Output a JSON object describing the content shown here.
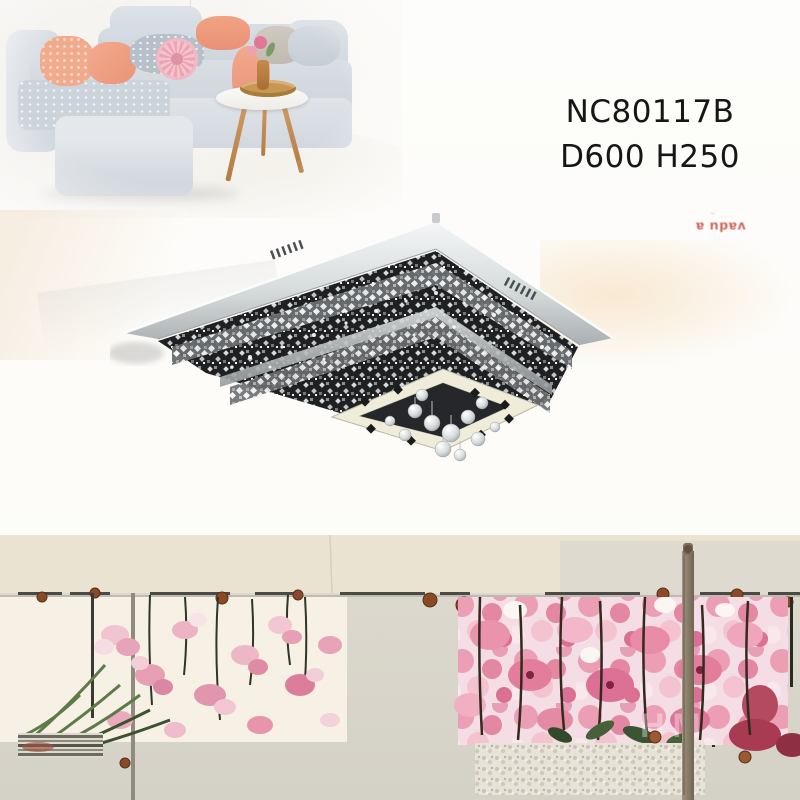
{
  "product": {
    "model": "NC80117B",
    "dimensions": "D600 H250",
    "text_color": "#161616"
  },
  "stamp": {
    "scribble": "~ ..",
    "text": "vadu a",
    "color": "#c2402f"
  },
  "watermark": {
    "text": "HM"
  },
  "labels": {
    "living_room_photo": "living room scene with grey sofa, peach cushions and round side table",
    "lamp_photo": "square chrome crystal LED ceiling lamp with hanging crystal balls",
    "mural_photo": "watercolor pink flower mural panels on fence with wooden poles"
  },
  "colors": {
    "page_bg": "#fdfcf9",
    "sofa_gray": "#ccd3da",
    "pillow_peach": "#f0ab8d",
    "pillow_pink": "#f2b8c3",
    "table_wood": "#c08a4f",
    "chrome_light": "#f2f4f4",
    "chrome_dark": "#aab0b2",
    "lamp_interior": "#1f2022",
    "band_beige": "#eae3d2",
    "ground_gray": "#d8d4c9",
    "panel_cream": "#f7f2e7",
    "flower_pink": "#e79fb6",
    "flower_deep": "#d97d9b",
    "flower_crimson": "#a83a52",
    "leaf_green": "#46603a",
    "knob_brown": "#8a4a26",
    "pole_wood": "#8d8173"
  }
}
